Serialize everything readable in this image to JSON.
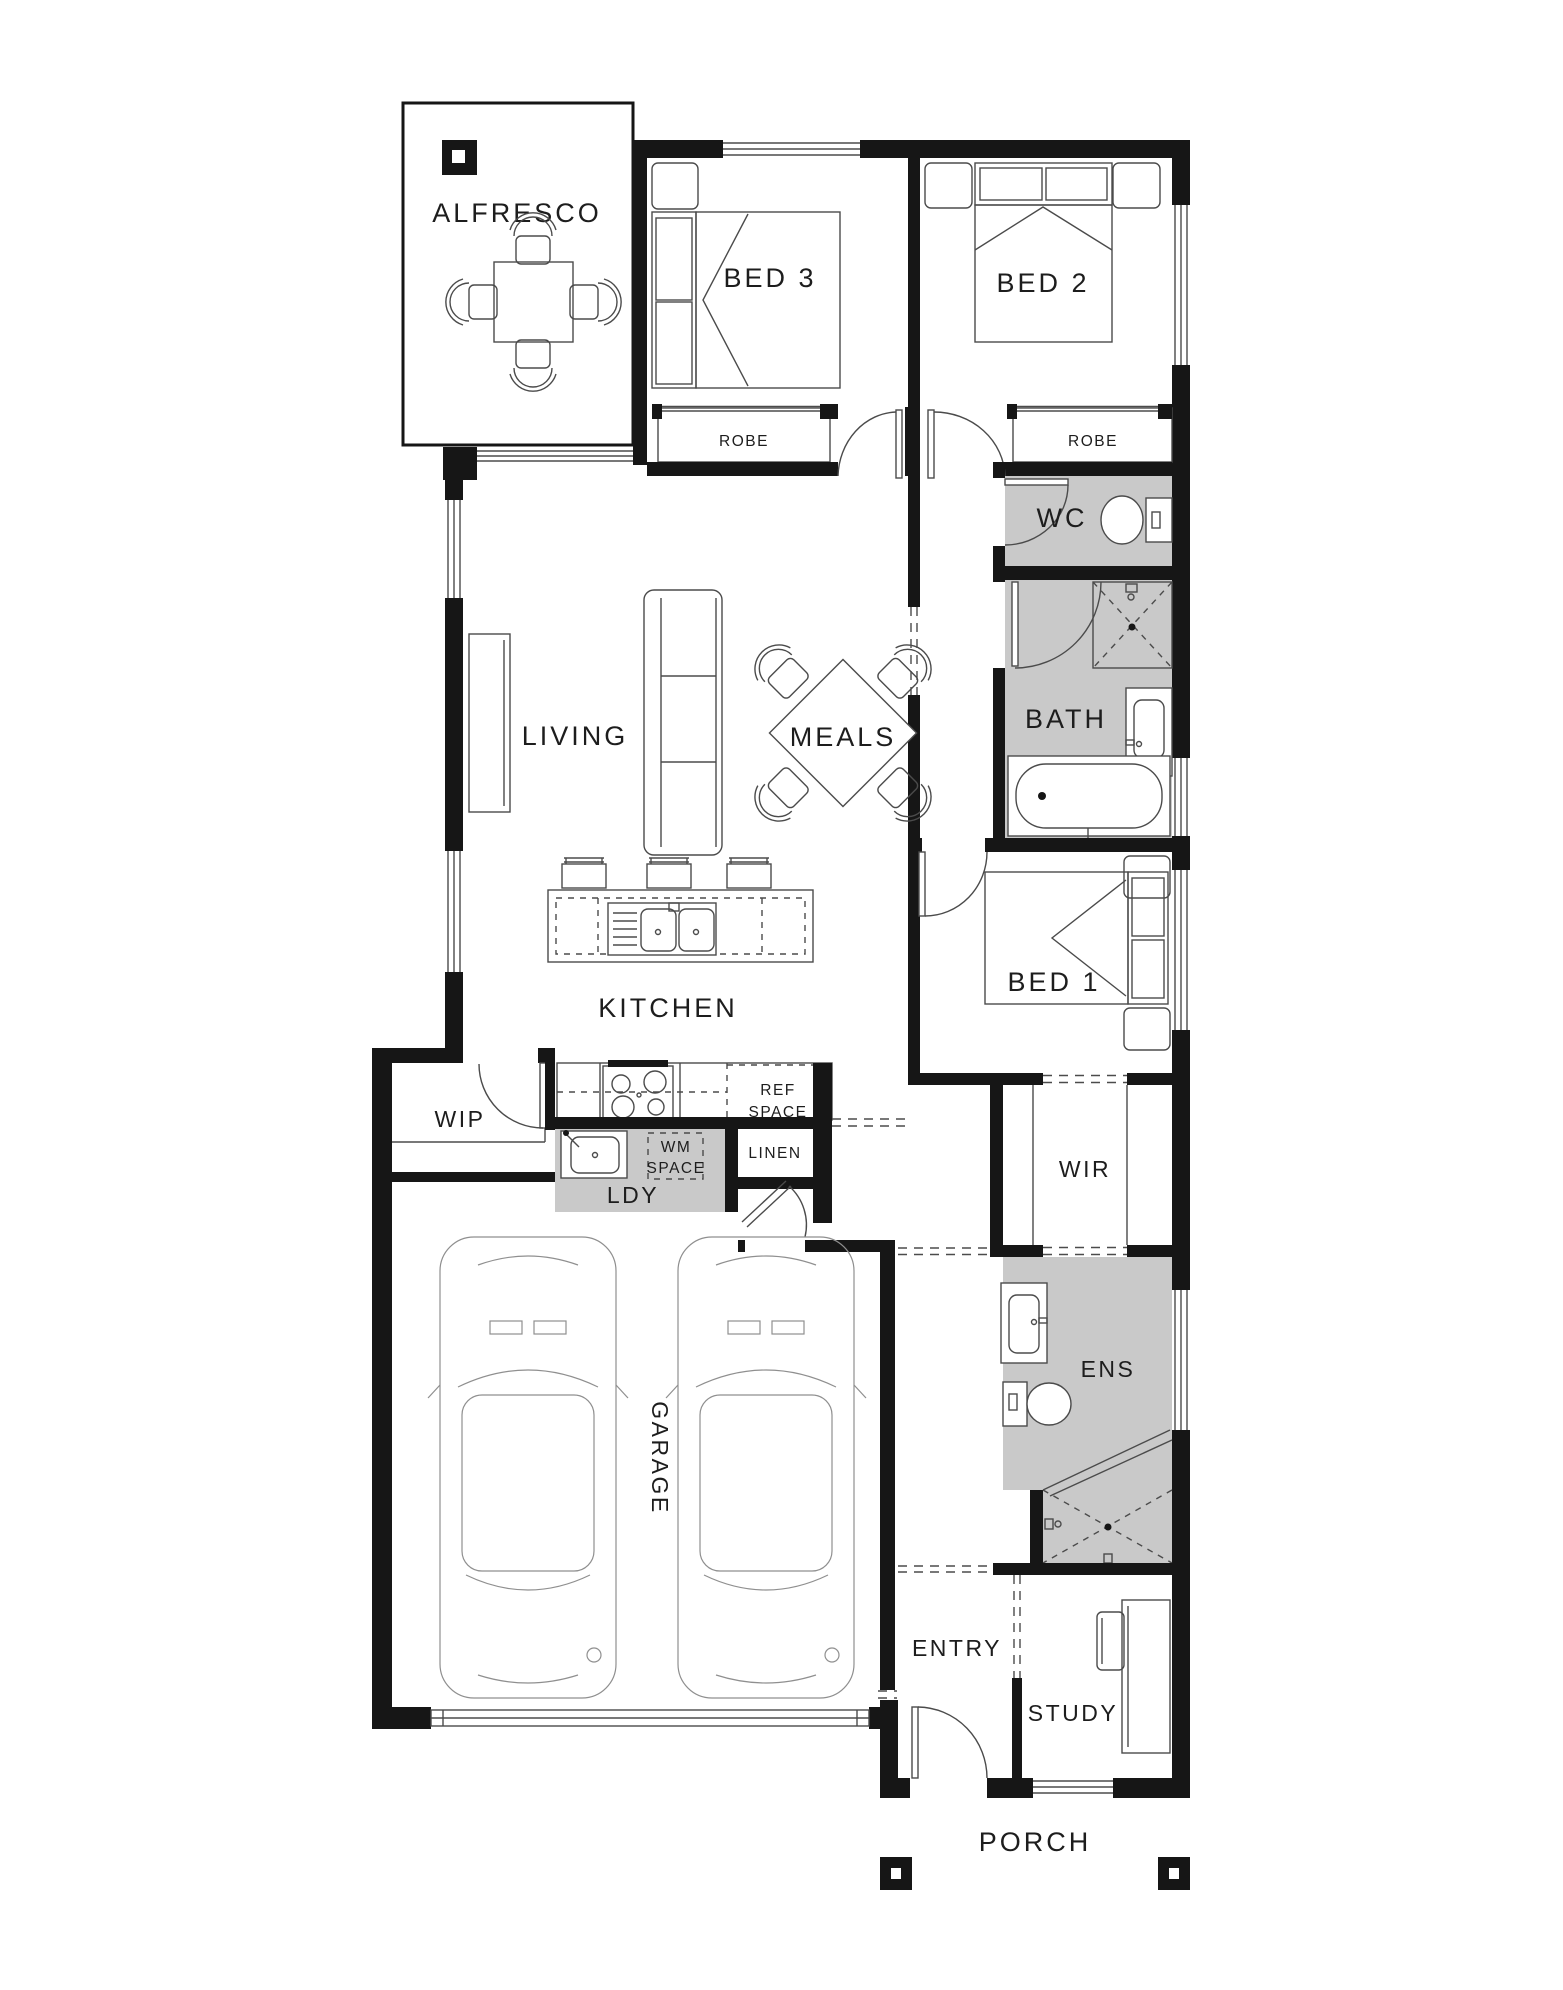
{
  "plan": {
    "type": "single-storey residential floor plan",
    "rooms": {
      "alfresco": "ALFRESCO",
      "bed3": "BED 3",
      "bed2": "BED 2",
      "robe3": "ROBE",
      "robe2": "ROBE",
      "wc": "WC",
      "living": "LIVING",
      "meals": "MEALS",
      "bath": "BATH",
      "bed1": "BED 1",
      "kitchen": "KITCHEN",
      "wip": "WIP",
      "ref_line1": "REF",
      "ref_line2": "SPACE",
      "wm_line1": "WM",
      "wm_line2": "SPACE",
      "linen": "LINEN",
      "ldy": "LDY",
      "wir": "WIR",
      "ens": "ENS",
      "garage": "GARAGE",
      "entry": "ENTRY",
      "study": "STUDY",
      "porch": "PORCH"
    },
    "colors": {
      "wall": "#161616",
      "wet_area": "#c9c9c9",
      "line": "#4b4b4b",
      "light_line": "#8f8f8f",
      "label": "#1d1d1d",
      "background": "#ffffff"
    }
  }
}
